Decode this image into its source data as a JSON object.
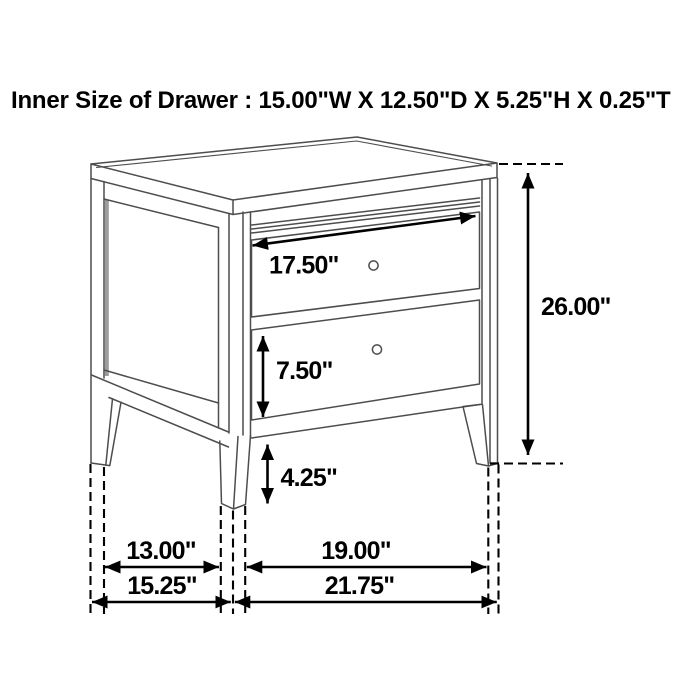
{
  "title": "Inner Size of Drawer : 15.00\"W X 12.50\"D X 5.25\"H X 0.25\"T",
  "inner_drawer_size": {
    "width": "15.00\"",
    "depth": "12.50\"",
    "height": "5.25\"",
    "thickness": "0.25\""
  },
  "dimensions": {
    "drawer_width": "17.50\"",
    "overall_height": "26.00\"",
    "bottom_drawer_front_height": "7.50\"",
    "leg_height": "4.25\"",
    "side_leg_inner_spacing": "13.00\"",
    "overall_depth": "15.25\"",
    "front_leg_inner_spacing": "19.00\"",
    "overall_width": "21.75\""
  },
  "colors": {
    "background": "#ffffff",
    "furniture_line": "#4d4d4d",
    "panel_shadow": "#9c9c9c",
    "annotation": "#000000"
  }
}
